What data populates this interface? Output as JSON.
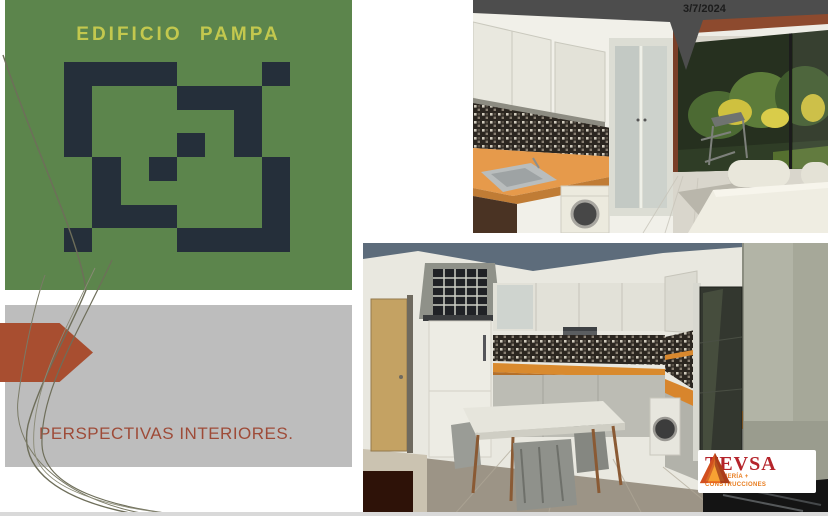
{
  "slide": {
    "date": "3/7/2024",
    "bottom_edge_color": "#d9d9d9"
  },
  "banner": {
    "title": "EDIFICIO PAMPA",
    "title_color": "#c3c84e",
    "background_color": "#5c854c",
    "logo_color": "#252f3a",
    "logo_grid": [
      "XXXX...X",
      "X...XXX.",
      "X.....X.",
      "X...X.X.",
      ".X.X...X",
      ".X.....X",
      ".XXX...X",
      "X...XXXX"
    ]
  },
  "caption": {
    "text": "PERSPECTIVAS INTERIORES.",
    "text_color": "#9e4b38",
    "panel_color": "#bdbdbd",
    "arrow_color": "#a84e30"
  },
  "tevsa": {
    "name": "TEVSA",
    "tagline_line1": "INGENIERÍA +",
    "tagline_line2": "CONSTRUCCIONES",
    "name_color": "#b5242b",
    "tagline_color": "#e87c1e"
  }
}
